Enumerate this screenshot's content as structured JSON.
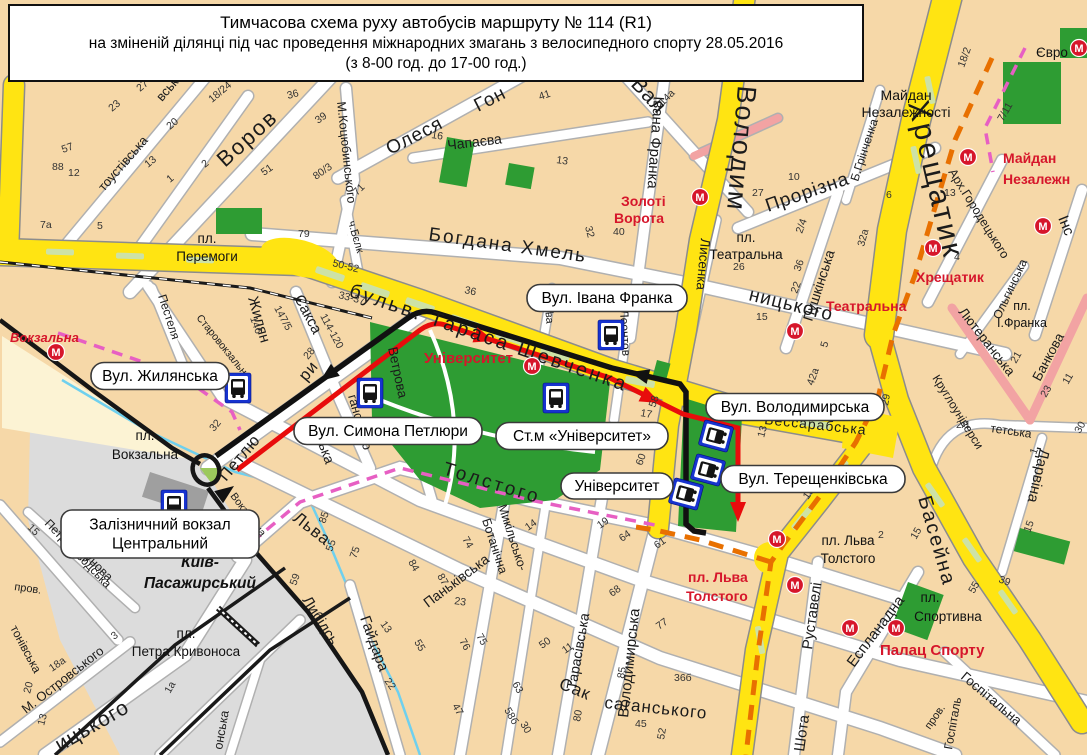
{
  "title": {
    "line1": "Тимчасова схема руху автобусів маршруту № 114 (R1)",
    "line2": "на зміненій ділянці під час проведення міжнародних змагань з велосипедного спорту 28.05.2016",
    "line3": "(з 8-00 год. до 17-00 год.)"
  },
  "colors": {
    "background": "#f6d8a8",
    "street_yellow": "#ffe412",
    "park_green": "#2e9c33",
    "route_black": "#111111",
    "route_red": "#e80c0c",
    "race_route_orange": "#e87000",
    "old_route_pink": "#e75fc3",
    "metro_red": "#d6162b",
    "bus_blue": "#1733cf",
    "rail_gray": "#dcdcdc",
    "river_blue": "#6fd0ee"
  },
  "callouts": [
    {
      "lines": [
        "Вул. Жилянська"
      ],
      "x": 160,
      "y": 376,
      "w": 138,
      "h": 27
    },
    {
      "lines": [
        "Вул. Симона Петлюри"
      ],
      "x": 388,
      "y": 431,
      "w": 188,
      "h": 27
    },
    {
      "lines": [
        "Вул. Івана Франка"
      ],
      "x": 607,
      "y": 298,
      "w": 160,
      "h": 27
    },
    {
      "lines": [
        "Ст.м «Університет»"
      ],
      "x": 582,
      "y": 436,
      "w": 172,
      "h": 27
    },
    {
      "lines": [
        "Вул. Володимирська"
      ],
      "x": 795,
      "y": 407,
      "w": 178,
      "h": 27
    },
    {
      "lines": [
        "Вул. Терещенківська"
      ],
      "x": 813,
      "y": 479,
      "w": 184,
      "h": 27
    },
    {
      "lines": [
        "Університет"
      ],
      "x": 617,
      "y": 486,
      "w": 112,
      "h": 26
    },
    {
      "lines": [
        "Залізничний вокзал",
        "Центральний"
      ],
      "x": 160,
      "y": 534,
      "w": 198,
      "h": 48
    }
  ],
  "red_labels": [
    {
      "t": "Вокзальна",
      "x": 10,
      "y": 342,
      "s": 13,
      "i": 1
    },
    {
      "t": "Університет",
      "x": 424,
      "y": 363,
      "s": 15,
      "i": 0
    },
    {
      "t": "Золоті",
      "x": 621,
      "y": 206,
      "s": 14,
      "i": 0
    },
    {
      "t": "Ворота",
      "x": 614,
      "y": 223,
      "s": 14,
      "i": 0
    },
    {
      "t": "Театральна",
      "x": 826,
      "y": 311,
      "s": 14,
      "i": 0
    },
    {
      "t": "Хрещатик",
      "x": 916,
      "y": 282,
      "s": 14,
      "i": 0
    },
    {
      "t": "Майдан",
      "x": 1003,
      "y": 163,
      "s": 14,
      "i": 0
    },
    {
      "t": "Незалежн",
      "x": 1003,
      "y": 184,
      "s": 14,
      "i": 0
    },
    {
      "t": "пл. Льва",
      "x": 688,
      "y": 582,
      "s": 14,
      "i": 0
    },
    {
      "t": "Толстого",
      "x": 686,
      "y": 601,
      "s": 14,
      "i": 0
    },
    {
      "t": "Палац Спорту",
      "x": 880,
      "y": 655,
      "s": 15,
      "i": 0
    }
  ],
  "area_labels": [
    {
      "t": "пл.",
      "x": 207,
      "y": 243,
      "s": 13.5,
      "b": 0
    },
    {
      "t": "Перемоги",
      "x": 207,
      "y": 261,
      "s": 13.5,
      "b": 0
    },
    {
      "t": "пл.",
      "x": 145,
      "y": 440,
      "s": 13.5,
      "b": 0
    },
    {
      "t": "Вокзальна",
      "x": 145,
      "y": 459,
      "s": 13.5,
      "b": 0
    },
    {
      "t": "Київ-",
      "x": 200,
      "y": 567,
      "s": 15.5,
      "b": 1
    },
    {
      "t": "Пасажирський",
      "x": 200,
      "y": 588,
      "s": 15.5,
      "b": 1
    },
    {
      "t": "пл.",
      "x": 186,
      "y": 638,
      "s": 13.5,
      "b": 0
    },
    {
      "t": "Петра Кривоноса",
      "x": 186,
      "y": 656,
      "s": 13.5,
      "b": 0
    },
    {
      "t": "пл.",
      "x": 746,
      "y": 242,
      "s": 13.5,
      "b": 0
    },
    {
      "t": "Театральна",
      "x": 746,
      "y": 259,
      "s": 13.5,
      "b": 0
    },
    {
      "t": "пл.",
      "x": 1022,
      "y": 310,
      "s": 12.5,
      "b": 0
    },
    {
      "t": "І.Франка",
      "x": 1022,
      "y": 327,
      "s": 12.5,
      "b": 0
    },
    {
      "t": "Майдан",
      "x": 906,
      "y": 100,
      "s": 14,
      "b": 0
    },
    {
      "t": "Незалежності",
      "x": 906,
      "y": 117,
      "s": 14,
      "b": 0
    },
    {
      "t": "пл. Льва",
      "x": 848,
      "y": 545,
      "s": 13.5,
      "b": 0
    },
    {
      "t": "Толстого",
      "x": 848,
      "y": 563,
      "s": 13.5,
      "b": 0
    },
    {
      "t": "пл.",
      "x": 930,
      "y": 602,
      "s": 13.5,
      "b": 0
    },
    {
      "t": "Спортивна",
      "x": 948,
      "y": 621,
      "s": 13.5,
      "b": 0
    },
    {
      "t": "Євро",
      "x": 1052,
      "y": 57,
      "s": 13.5,
      "b": 0
    }
  ],
  "street_labels": [
    {
      "t": "бульв. Тараса Шевченка",
      "x": 348,
      "y": 296,
      "r": 19,
      "s": 20,
      "ls": 3
    },
    {
      "t": "Володим",
      "x": 738,
      "y": 85,
      "r": 95,
      "s": 27,
      "ls": 2
    },
    {
      "t": "Хрещатик",
      "x": 908,
      "y": 103,
      "r": 77,
      "s": 30,
      "ls": 3
    },
    {
      "t": "Басейна",
      "x": 918,
      "y": 498,
      "r": 74,
      "s": 20,
      "ls": 2
    },
    {
      "t": "Воров",
      "x": 225,
      "y": 168,
      "r": -42,
      "s": 22,
      "ls": 2
    },
    {
      "t": "Олеся",
      "x": 390,
      "y": 155,
      "r": -27,
      "s": 19,
      "ls": 1
    },
    {
      "t": "Гон",
      "x": 478,
      "y": 112,
      "r": -27,
      "s": 19,
      "ls": 1
    },
    {
      "t": "М.Коцюбинського",
      "x": 337,
      "y": 102,
      "r": 84,
      "s": 12.5
    },
    {
      "t": "Чапаєва",
      "x": 448,
      "y": 150,
      "r": -7,
      "s": 14
    },
    {
      "t": "Івана Франка",
      "x": 654,
      "y": 96,
      "r": 94,
      "s": 15
    },
    {
      "t": "Лисенка",
      "x": 701,
      "y": 238,
      "r": 95,
      "s": 13.5
    },
    {
      "t": "Вал",
      "x": 630,
      "y": 85,
      "r": 47,
      "s": 21,
      "ls": 1
    },
    {
      "t": "Богдана Хмель",
      "x": 428,
      "y": 240,
      "r": 8,
      "s": 19,
      "ls": 2
    },
    {
      "t": "ницького",
      "x": 748,
      "y": 300,
      "r": 14,
      "s": 19,
      "ls": 1
    },
    {
      "t": "Прорізна",
      "x": 768,
      "y": 212,
      "r": -19,
      "s": 19,
      "ls": 1
    },
    {
      "t": "Пушкінська",
      "x": 812,
      "y": 322,
      "r": -72,
      "s": 14
    },
    {
      "t": "Б.Грінченка",
      "x": 858,
      "y": 182,
      "r": -72,
      "s": 12
    },
    {
      "t": "Арх.Городецького",
      "x": 948,
      "y": 172,
      "r": 58,
      "s": 12.5
    },
    {
      "t": "Ольгинська",
      "x": 1000,
      "y": 320,
      "r": -65,
      "s": 12
    },
    {
      "t": "Інс",
      "x": 1058,
      "y": 218,
      "r": 68,
      "s": 15
    },
    {
      "t": "Лютеранська",
      "x": 958,
      "y": 312,
      "r": 52,
      "s": 13.5
    },
    {
      "t": "Банкова",
      "x": 1040,
      "y": 382,
      "r": -62,
      "s": 13.5
    },
    {
      "t": "Круглоуніверси",
      "x": 932,
      "y": 378,
      "r": 58,
      "s": 12
    },
    {
      "t": "тетська",
      "x": 990,
      "y": 432,
      "r": 8,
      "s": 12
    },
    {
      "t": "Дарвіна",
      "x": 1040,
      "y": 448,
      "r": 103,
      "s": 15
    },
    {
      "t": "Бессарабська",
      "x": 764,
      "y": 424,
      "r": 6,
      "s": 14,
      "ls": 1
    },
    {
      "t": "Толстого",
      "x": 442,
      "y": 474,
      "r": 17,
      "s": 19,
      "ls": 3
    },
    {
      "t": "Льва",
      "x": 292,
      "y": 520,
      "r": 38,
      "s": 17,
      "ls": 1
    },
    {
      "t": "Либідсь",
      "x": 302,
      "y": 600,
      "r": 58,
      "s": 15
    },
    {
      "t": "Гайдара",
      "x": 360,
      "y": 618,
      "r": 70,
      "s": 15
    },
    {
      "t": "Паньківська",
      "x": 428,
      "y": 608,
      "r": -37,
      "s": 14
    },
    {
      "t": "Микільсько-",
      "x": 498,
      "y": 506,
      "r": 72,
      "s": 12.5
    },
    {
      "t": "Ботанічна",
      "x": 482,
      "y": 520,
      "r": 72,
      "s": 12.5
    },
    {
      "t": "Тарасівська",
      "x": 576,
      "y": 690,
      "r": -80,
      "s": 14
    },
    {
      "t": "Сак",
      "x": 558,
      "y": 688,
      "r": 22,
      "s": 17,
      "ls": 1
    },
    {
      "t": "саганського",
      "x": 604,
      "y": 708,
      "r": 6,
      "s": 17,
      "ls": 1
    },
    {
      "t": "Володимирська",
      "x": 628,
      "y": 718,
      "r": -84,
      "s": 15
    },
    {
      "t": "Жилян",
      "x": 248,
      "y": 298,
      "r": 74,
      "s": 15
    },
    {
      "t": "Сакса",
      "x": 294,
      "y": 298,
      "r": 62,
      "s": 15
    },
    {
      "t": "ська",
      "x": 316,
      "y": 438,
      "r": 70,
      "s": 14
    },
    {
      "t": "ганського",
      "x": 348,
      "y": 396,
      "r": 74,
      "s": 13
    },
    {
      "t": "Петлю",
      "x": 226,
      "y": 482,
      "r": -50,
      "s": 16.5,
      "ls": 1
    },
    {
      "t": "ри",
      "x": 306,
      "y": 382,
      "r": -50,
      "s": 16.5,
      "ls": 1
    },
    {
      "t": "Ветрова",
      "x": 388,
      "y": 348,
      "r": 78,
      "s": 13.5
    },
    {
      "t": "Старовокзальна",
      "x": 196,
      "y": 318,
      "r": 51,
      "s": 10.5
    },
    {
      "t": "Пестеля",
      "x": 158,
      "y": 296,
      "r": 72,
      "s": 12
    },
    {
      "t": "Вокзальна",
      "x": 230,
      "y": 496,
      "r": 53,
      "s": 10.5
    },
    {
      "t": "Леонтов",
      "x": 620,
      "y": 310,
      "r": 87,
      "s": 12
    },
    {
      "t": "ова",
      "x": 545,
      "y": 306,
      "r": 85,
      "s": 11
    },
    {
      "t": "тоустівська",
      "x": 104,
      "y": 192,
      "r": -49,
      "s": 13
    },
    {
      "t": "вська",
      "x": 162,
      "y": 102,
      "r": -49,
      "s": 13
    },
    {
      "t": "Руставелі",
      "x": 812,
      "y": 650,
      "r": -82,
      "s": 15
    },
    {
      "t": "Шота",
      "x": 804,
      "y": 752,
      "r": -82,
      "s": 15
    },
    {
      "t": "Еспланадна",
      "x": 854,
      "y": 668,
      "r": -53,
      "s": 15
    },
    {
      "t": "Госпітальна",
      "x": 960,
      "y": 678,
      "r": 40,
      "s": 13.5
    },
    {
      "t": "Госпіталь",
      "x": 952,
      "y": 750,
      "r": -80,
      "s": 12
    },
    {
      "t": "пров.",
      "x": 930,
      "y": 730,
      "r": -55,
      "s": 11
    },
    {
      "t": "Петрозаводська",
      "x": 44,
      "y": 524,
      "r": 46,
      "s": 12
    },
    {
      "t": "Ползунова",
      "x": 64,
      "y": 538,
      "r": 45,
      "s": 12.5
    },
    {
      "t": "М. Островського",
      "x": 26,
      "y": 714,
      "r": -38,
      "s": 13
    },
    {
      "t": "ицького",
      "x": 60,
      "y": 752,
      "r": -30,
      "s": 21,
      "ls": 1
    },
    {
      "t": "тонівська",
      "x": 10,
      "y": 628,
      "r": 62,
      "s": 12
    },
    {
      "t": "онська",
      "x": 222,
      "y": 750,
      "r": -80,
      "s": 12.5
    },
    {
      "t": "ч.Бєлк",
      "x": 348,
      "y": 222,
      "r": 74,
      "s": 11
    },
    {
      "t": "пров.",
      "x": 14,
      "y": 590,
      "r": 8,
      "s": 11
    }
  ],
  "house_numbers": [
    [
      "12",
      68,
      176,
      0
    ],
    [
      "7а",
      40,
      228,
      0
    ],
    [
      "5",
      97,
      229,
      0
    ],
    [
      "88",
      52,
      170,
      0
    ],
    [
      "57",
      63,
      153,
      -20
    ],
    [
      "23",
      112,
      112,
      -40
    ],
    [
      "27",
      140,
      92,
      -40
    ],
    [
      "20",
      170,
      130,
      -40
    ],
    [
      "13",
      148,
      168,
      -40
    ],
    [
      "1",
      170,
      183,
      -40
    ],
    [
      "2",
      205,
      168,
      -40
    ],
    [
      "18/24",
      212,
      103,
      -40
    ],
    [
      "36",
      288,
      99,
      -15
    ],
    [
      "39",
      318,
      124,
      -35
    ],
    [
      "51",
      264,
      176,
      -35
    ],
    [
      "80/3",
      316,
      180,
      -35
    ],
    [
      "79",
      298,
      237,
      0
    ],
    [
      "71",
      357,
      196,
      -45
    ],
    [
      "50-52",
      332,
      266,
      14
    ],
    [
      "33-37",
      338,
      298,
      14
    ],
    [
      "114-120",
      320,
      316,
      62
    ],
    [
      "147/5",
      274,
      308,
      62
    ],
    [
      "146",
      250,
      318,
      70
    ],
    [
      "28",
      308,
      360,
      -50
    ],
    [
      "32",
      214,
      432,
      -50
    ],
    [
      "36",
      464,
      293,
      12
    ],
    [
      "26",
      543,
      311,
      12
    ],
    [
      "16",
      431,
      138,
      8
    ],
    [
      "41",
      540,
      100,
      -18
    ],
    [
      "13",
      556,
      163,
      8
    ],
    [
      "40",
      613,
      235,
      0
    ],
    [
      "32",
      585,
      227,
      75
    ],
    [
      "17",
      640,
      416,
      10
    ],
    [
      "58",
      655,
      408,
      -70
    ],
    [
      "60",
      642,
      466,
      -70
    ],
    [
      "54",
      672,
      310,
      -45
    ],
    [
      "14а",
      663,
      106,
      -45
    ],
    [
      "27",
      752,
      196,
      0
    ],
    [
      "26",
      733,
      270,
      0
    ],
    [
      "15",
      756,
      320,
      0
    ],
    [
      "10",
      788,
      180,
      0
    ],
    [
      "2/4",
      802,
      234,
      -70
    ],
    [
      "36",
      800,
      272,
      -70
    ],
    [
      "22",
      797,
      294,
      -70
    ],
    [
      "32а",
      864,
      247,
      -75
    ],
    [
      "6",
      886,
      198,
      0
    ],
    [
      "13",
      944,
      196,
      0
    ],
    [
      "4",
      954,
      260,
      0
    ],
    [
      "7/11",
      1003,
      122,
      -60
    ],
    [
      "18/2",
      964,
      68,
      -70
    ],
    [
      "21",
      1016,
      364,
      -60
    ],
    [
      "23",
      1046,
      398,
      -60
    ],
    [
      "11",
      1068,
      385,
      -60
    ],
    [
      "30",
      1080,
      434,
      -60
    ],
    [
      "2/1",
      956,
      428,
      0
    ],
    [
      "1",
      1036,
      455,
      -70
    ],
    [
      "15",
      1030,
      533,
      -70
    ],
    [
      "29",
      888,
      406,
      -80
    ],
    [
      "13",
      764,
      438,
      -75
    ],
    [
      "10",
      808,
      500,
      -55
    ],
    [
      "5",
      827,
      348,
      -75
    ],
    [
      "42а",
      813,
      386,
      -70
    ],
    [
      "2",
      878,
      538,
      0
    ],
    [
      "39",
      998,
      582,
      20
    ],
    [
      "15",
      916,
      540,
      -60
    ],
    [
      "55",
      974,
      594,
      -60
    ],
    [
      "85",
      325,
      524,
      -70
    ],
    [
      "55",
      332,
      552,
      -70
    ],
    [
      "75",
      356,
      559,
      -70
    ],
    [
      "59",
      296,
      586,
      -70
    ],
    [
      "13",
      380,
      624,
      55
    ],
    [
      "22",
      384,
      681,
      55
    ],
    [
      "84",
      408,
      562,
      60
    ],
    [
      "87",
      437,
      576,
      60
    ],
    [
      "74",
      462,
      539,
      60
    ],
    [
      "23",
      454,
      604,
      8
    ],
    [
      "76",
      459,
      641,
      60
    ],
    [
      "75",
      476,
      636,
      60
    ],
    [
      "55",
      414,
      642,
      60
    ],
    [
      "47",
      452,
      706,
      60
    ],
    [
      "63",
      512,
      684,
      60
    ],
    [
      "58б",
      504,
      710,
      60
    ],
    [
      "30",
      520,
      724,
      60
    ],
    [
      "14",
      528,
      531,
      -35
    ],
    [
      "19",
      600,
      529,
      -35
    ],
    [
      "64",
      622,
      542,
      -35
    ],
    [
      "61",
      657,
      549,
      -35
    ],
    [
      "68",
      612,
      597,
      -35
    ],
    [
      "77",
      659,
      630,
      -35
    ],
    [
      "36б",
      674,
      681,
      0
    ],
    [
      "45",
      635,
      727,
      0
    ],
    [
      "85",
      624,
      679,
      -80
    ],
    [
      "80",
      580,
      722,
      -80
    ],
    [
      "11",
      565,
      654,
      -35
    ],
    [
      "50",
      542,
      649,
      -35
    ],
    [
      "52",
      664,
      740,
      -80
    ],
    [
      "15",
      27,
      528,
      45
    ],
    [
      "18а",
      52,
      672,
      -35
    ],
    [
      "20",
      30,
      694,
      -75
    ],
    [
      "13",
      44,
      726,
      -75
    ],
    [
      "3",
      114,
      640,
      -35
    ],
    [
      "1а",
      170,
      694,
      -60
    ]
  ],
  "metro_icons": [
    [
      56,
      352
    ],
    [
      532,
      366
    ],
    [
      700,
      197
    ],
    [
      795,
      331
    ],
    [
      933,
      248
    ],
    [
      1043,
      226
    ],
    [
      968,
      157
    ],
    [
      777,
      539
    ],
    [
      795,
      585
    ],
    [
      850,
      628
    ],
    [
      896,
      628
    ],
    [
      1079,
      48
    ]
  ],
  "bus_stops": [
    [
      238,
      388,
      0
    ],
    [
      370,
      393,
      0
    ],
    [
      556,
      398,
      0
    ],
    [
      611,
      335,
      0
    ],
    [
      174,
      505,
      0
    ],
    [
      716,
      436,
      -75
    ],
    [
      708,
      470,
      -75
    ],
    [
      686,
      494,
      -75
    ]
  ]
}
